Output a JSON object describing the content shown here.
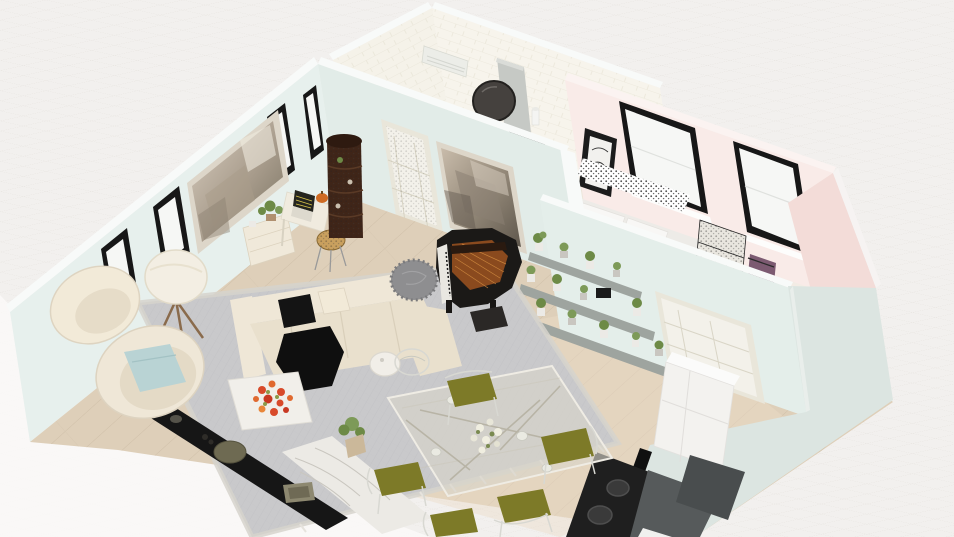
{
  "canvas": {
    "width": 954,
    "height": 537,
    "view": "3d-perspective-floorplan-render"
  },
  "palette": {
    "bg": "#f2f0ee",
    "brightZone": "#fbfaf9",
    "whiteTrim": "#f8faf9",
    "mintWall": "#e7f0ed",
    "mintWallMid": "#e2ece8",
    "mintWallDivider": "#e4eeea",
    "mintExterior": "#dce5e1",
    "brickWallA": "#f5f2e9",
    "brickWallB": "#f7f4ec",
    "vanityFloor": "#ece6da",
    "pinkWall": "#f9ebe8",
    "pinkWallDark": "#f3dcd8",
    "bedroomFloor": "#f3ece5",
    "woodFloor": "#decfb9",
    "woodWash": "#eadcc8",
    "rug": "#c9c9cb",
    "rugBorder": "#d6d3cd",
    "windowFrame": "#171717",
    "windowGlass": "#f6f7f5",
    "doorFrame": "#e9e6da",
    "doorFace": "#f3f1ea",
    "paintFrame": "#ddd6c9",
    "cream": "#efe7d7",
    "creamDark": "#e9e0cd",
    "creamLight": "#f2ead8",
    "pillowBlack": "#141414",
    "throwBlack": "#0f0f0f",
    "pillowBlue": "#b9d3d4",
    "coffeeTableWhite": "#f1efea",
    "flowerRed": "#d84a2a",
    "flowerOrange": "#e0692f",
    "leafGreen": "#6d8a46",
    "leafGreenLight": "#7d9a58",
    "marbleBench": "#eceae5",
    "consoleBlack": "#161616",
    "trayOlive": "#6e6a52",
    "boxTan": "#8d8870",
    "pianoBlack": "#1b1917",
    "pianoCopper": "#8a4a1e",
    "pianoStrings": "#c8833c",
    "pianoKeys": "#e9e7e1",
    "benchDark": "#2b2826",
    "stoolShaggy": "#8e8e90",
    "shelfGray": "#9ea49f",
    "potWhite": "#eceae6",
    "towerBrown": "#3f2518",
    "towerTop": "#2e1a10",
    "lampShade": "#f3eee3",
    "lampLeg": "#8a6b4c",
    "sideboard": "#f0e9da",
    "deskWhite": "#f0ebdf",
    "laptopDark": "#25251f",
    "laptopLines": "#d8c34a",
    "pumpkin": "#cf6b24",
    "stoolSeat": "#c9a05e",
    "sideTableWhite": "#f1eee8",
    "glassTable": "#d9d5c9",
    "chairOlive": "#7d7a28",
    "chairWire": "#d8d8d2",
    "centerpieceWhite": "#f0eee0",
    "counterWhite": "#f3f2ef",
    "cooktopBlack": "#1f1f1f",
    "burnerGray": "#3a3a3a",
    "hoodGray": "#565a5b",
    "hoodGrayDark": "#494d4e",
    "mirrorDark": "#45413e",
    "acUnit": "#ecede8",
    "panelGray": "#c6c9c5",
    "bedWhite": "#edebe7",
    "pillowWhite": "#f8f7f5",
    "blanketGray": "#cfcdc9",
    "artFrame": "#1c1c1c",
    "ladderShelf": "#e9e6df",
    "purpleRack": "#7c5a71",
    "bedsideGray": "#b9b7b3",
    "plumFlower": "#9e4a55"
  },
  "scene": {
    "rooms": [
      {
        "id": "living-room",
        "wall_color": "#e7f0ed",
        "floor": "gray herringbone rug over oak planks"
      },
      {
        "id": "vanity-room",
        "wall_color": "#f5f2e9",
        "floor": "white brick walls, tile floor"
      },
      {
        "id": "bedroom",
        "wall_color": "#f9ebe8",
        "floor": "pink walls, two black-frame windows"
      },
      {
        "id": "dining-area",
        "wall_color": "#e4eeea",
        "floor": "oak planks"
      },
      {
        "id": "kitchen-nook",
        "wall_color": "#dce5e1",
        "floor": "oak planks"
      }
    ],
    "furniture": [
      {
        "id": "area-rug",
        "room": "living-room"
      },
      {
        "id": "sectional-sofa",
        "room": "living-room"
      },
      {
        "id": "egg-chair",
        "room": "living-room"
      },
      {
        "id": "lounge-chair",
        "room": "living-room"
      },
      {
        "id": "tripod-floor-lamp",
        "room": "living-room"
      },
      {
        "id": "coffee-table",
        "room": "living-room"
      },
      {
        "id": "red-flower-bouquet",
        "room": "living-room"
      },
      {
        "id": "tv-console",
        "room": "living-room"
      },
      {
        "id": "marble-bench",
        "room": "living-room"
      },
      {
        "id": "grand-piano",
        "room": "living-room"
      },
      {
        "id": "piano-bench",
        "room": "living-room"
      },
      {
        "id": "shaggy-stool",
        "room": "living-room"
      },
      {
        "id": "plant-shelves",
        "room": "living-room",
        "count_pots": 14
      },
      {
        "id": "sideboard",
        "room": "living-room"
      },
      {
        "id": "desk",
        "room": "living-room"
      },
      {
        "id": "laptop",
        "room": "living-room"
      },
      {
        "id": "desk-stool",
        "room": "living-room"
      },
      {
        "id": "curio-tower",
        "room": "living-room"
      },
      {
        "id": "dining-table",
        "room": "dining-area"
      },
      {
        "id": "dining-chair",
        "room": "dining-area",
        "count": 5,
        "cushion": "olive"
      },
      {
        "id": "centerpiece-flowers",
        "room": "dining-area"
      },
      {
        "id": "kitchen-cabinet",
        "room": "kitchen-nook"
      },
      {
        "id": "cooktop",
        "room": "kitchen-nook"
      },
      {
        "id": "range-hood",
        "room": "kitchen-nook"
      },
      {
        "id": "bed",
        "room": "bedroom"
      },
      {
        "id": "leaning-wall-art",
        "room": "bedroom"
      },
      {
        "id": "ladder-shelf",
        "room": "bedroom"
      },
      {
        "id": "clothes-rack",
        "room": "bedroom"
      },
      {
        "id": "bedside-table",
        "room": "bedroom"
      },
      {
        "id": "round-mirror",
        "room": "vanity-room"
      },
      {
        "id": "ac-unit",
        "room": "vanity-room"
      },
      {
        "id": "vanity-panel",
        "room": "vanity-room"
      }
    ],
    "openings": [
      {
        "id": "window-left-1",
        "wall": "left"
      },
      {
        "id": "window-left-2",
        "wall": "left"
      },
      {
        "id": "window-left-3",
        "wall": "left"
      },
      {
        "id": "window-left-4",
        "wall": "left"
      },
      {
        "id": "window-bedroom-1",
        "wall": "bedroom-far"
      },
      {
        "id": "window-bedroom-2",
        "wall": "bedroom-far"
      },
      {
        "id": "door-hall",
        "wall": "top"
      },
      {
        "id": "door-right",
        "wall": "divider"
      }
    ],
    "art": [
      {
        "id": "abstract-painting-left",
        "wall": "left"
      },
      {
        "id": "abstract-painting-top",
        "wall": "top"
      }
    ]
  }
}
